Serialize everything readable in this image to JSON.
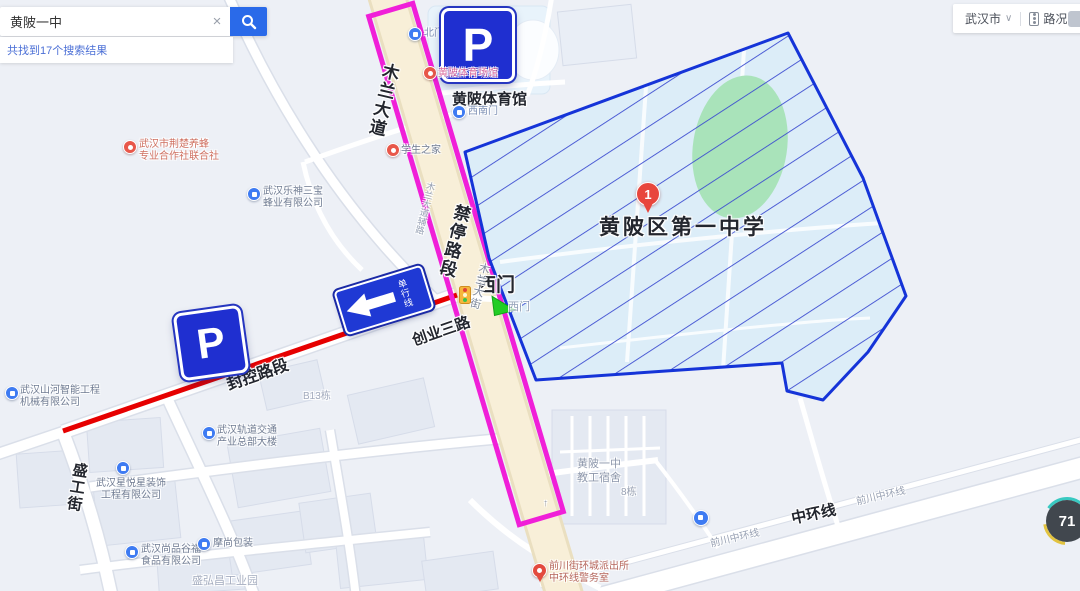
{
  "colors": {
    "brand_blue": "#2a6ae9",
    "polygon_border": "#1534d8",
    "polygon_fill": "#d9ecf8",
    "hatch_line": "#3a4ad0",
    "field_green": "#a9e3ba",
    "no_stop_magenta": "#f01fd8",
    "closed_red": "#e60000",
    "sign_blue": "#1f2fd0",
    "marker_red": "#e8463c",
    "arrow_green": "#22cd25"
  },
  "search": {
    "query": "黄陂一中",
    "clear_label": "×",
    "results_text": "共找到17个搜索结果"
  },
  "topbar": {
    "city": "武汉市",
    "caret": "∨",
    "traffic": "路况"
  },
  "labels": {
    "mulan_avenue": "木兰大道",
    "no_stop_section": "禁停路段",
    "gym": "黄陂体育馆",
    "school": "黄陂区第一中学",
    "west_gate": "西门",
    "west_gate_small": "西门",
    "chuangye_3rd_road": "创业三路",
    "closed_section": "封控路段",
    "one_way": "单行线",
    "mulan_street": "木兰大街",
    "mulan_side_road": "木兰大道辅路",
    "shenggong_street": "盛工街",
    "middle_ring": "中环线",
    "qianchuan_ring_1": "前川中环线",
    "qianchuan_ring_2": "前川中环线",
    "dorm": "黄陂一中\n教工宿舍",
    "bldg8": "8栋",
    "bldg_b13": "B13栋",
    "industrial_park": "盛弘昌工业园",
    "north_gate": "北门",
    "southwest_gate": "西南门",
    "road_arrow": "↑"
  },
  "pois": {
    "bee_coop": "武汉市荆楚养蜂\n专业合作社联合社",
    "leshen": "武汉乐神三宝\n蜂业有限公司",
    "stadium": "黄陂体育场馆",
    "student_home": "学生之家",
    "shanhe": "武汉山河智能工程\n机械有限公司",
    "rail": "武汉轨道交通\n产业总部大楼",
    "xingyue": "武汉星悦星装饰\n工程有限公司",
    "shangpin": "武汉尚品谷福\n食品有限公司",
    "moshang": "摩尚包装",
    "police": "前川街环城派出所\n中环线警务室"
  },
  "markers": {
    "school_number": "1",
    "parking": "P"
  },
  "badge": {
    "value": "71"
  }
}
